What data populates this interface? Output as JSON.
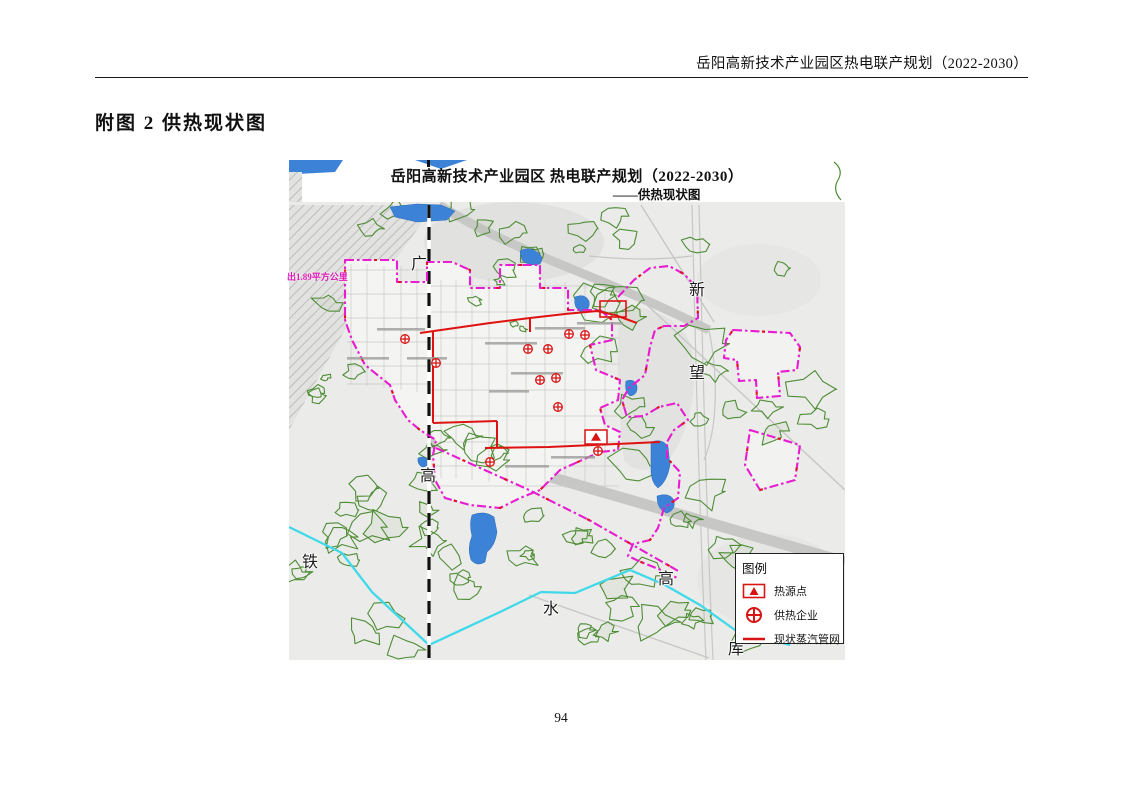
{
  "page": {
    "header_title": "岳阳高新技术产业园区热电联产规划（2022-2030）",
    "figure_title": "附图 2 供热现状图",
    "page_number": "94"
  },
  "map": {
    "title_line1": "岳阳高新技术产业园区 热电联产规划（2022-2030）",
    "title_line2": "——供热现状图",
    "area_note": "出1.89平方公里",
    "labels": [
      {
        "name": "railway-label-guang",
        "text": "广"
      },
      {
        "name": "road-label-xin",
        "text": "新"
      },
      {
        "name": "road-label-wang",
        "text": "望"
      },
      {
        "name": "railway-label-gao",
        "text": "高"
      },
      {
        "name": "reservoir-label-tie",
        "text": "铁"
      },
      {
        "name": "reservoir-label-shui",
        "text": "水"
      },
      {
        "name": "road-label-gao-right",
        "text": "高"
      },
      {
        "name": "reservoir-label-ku",
        "text": "库"
      }
    ],
    "legend": {
      "title": "图例",
      "items": [
        {
          "label": "热源点",
          "symbol": "heat-source-triangle"
        },
        {
          "label": "供热企业",
          "symbol": "heating-enterprise-circle-cross"
        },
        {
          "label": "现状蒸汽管网",
          "symbol": "existing-steam-pipeline"
        }
      ]
    },
    "symbols": {
      "heat_sources": [
        {
          "x": 307,
          "y": 277
        }
      ],
      "heating_enterprises": [
        {
          "x": 116,
          "y": 179
        },
        {
          "x": 147,
          "y": 203
        },
        {
          "x": 239,
          "y": 189
        },
        {
          "x": 259,
          "y": 189
        },
        {
          "x": 280,
          "y": 174
        },
        {
          "x": 296,
          "y": 175
        },
        {
          "x": 251,
          "y": 220
        },
        {
          "x": 267,
          "y": 218
        },
        {
          "x": 269,
          "y": 247
        },
        {
          "x": 309,
          "y": 291
        },
        {
          "x": 201,
          "y": 302
        }
      ]
    },
    "colors": {
      "boundary": "#e81cd0",
      "pipeline": "#df1212",
      "symbol": "#d81414",
      "river": "#3fd9ea",
      "water": "#3c83d8",
      "vegetation": "#4e8d36"
    }
  }
}
